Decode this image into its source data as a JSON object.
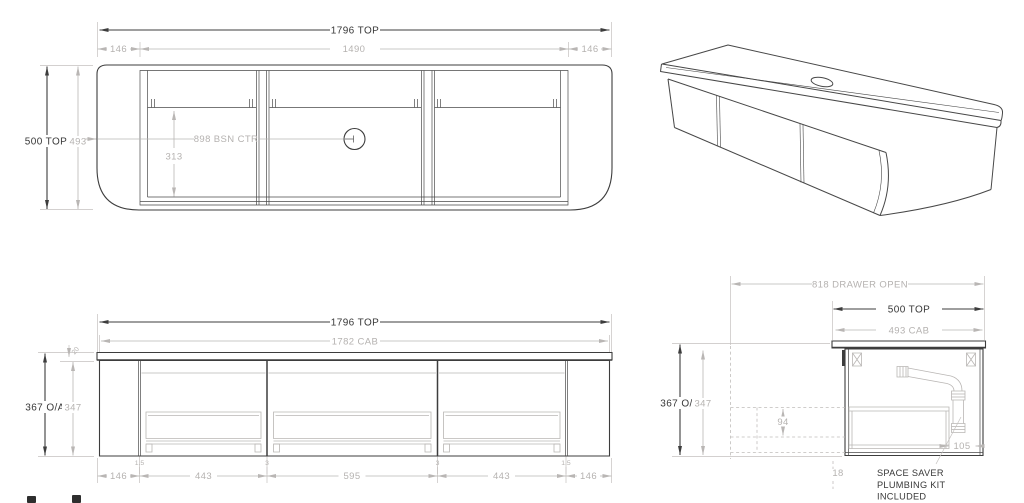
{
  "colors": {
    "line_dark": "#3d3d3d",
    "line_gray": "#b9b6b4",
    "text_dark": "#383838",
    "text_gray": "#b5b2b0",
    "background": "#ffffff"
  },
  "plan_view": {
    "overall_width": "1796 TOP",
    "left_end": "146",
    "cab_width": "1490",
    "right_end": "146",
    "overall_depth": "500 TOP",
    "cab_depth": "493",
    "basin_centre": "898  BSN CTR",
    "basin_setback": "313"
  },
  "front_view": {
    "overall_width": "1796 TOP",
    "cab_width": "1782 CAB",
    "overall_height": "367 O/A",
    "cab_height": "347",
    "top_thickness": "20",
    "bottom_dims": [
      "146",
      "443",
      "595",
      "443",
      "146"
    ],
    "gap_dims": [
      "1.5",
      "3",
      "3",
      "1.5"
    ]
  },
  "side_view": {
    "drawer_open": "818 DRAWER OPEN",
    "overall_depth": "500 TOP",
    "cab_depth": "493 CAB",
    "overall_height": "367 O/A",
    "cab_height": "347",
    "drawer_clearance": "94",
    "wall_gap": "18",
    "trap_offset": "105",
    "note_line1": "SPACE SAVER",
    "note_line2": "PLUMBING KIT",
    "note_line3": "INCLUDED"
  }
}
